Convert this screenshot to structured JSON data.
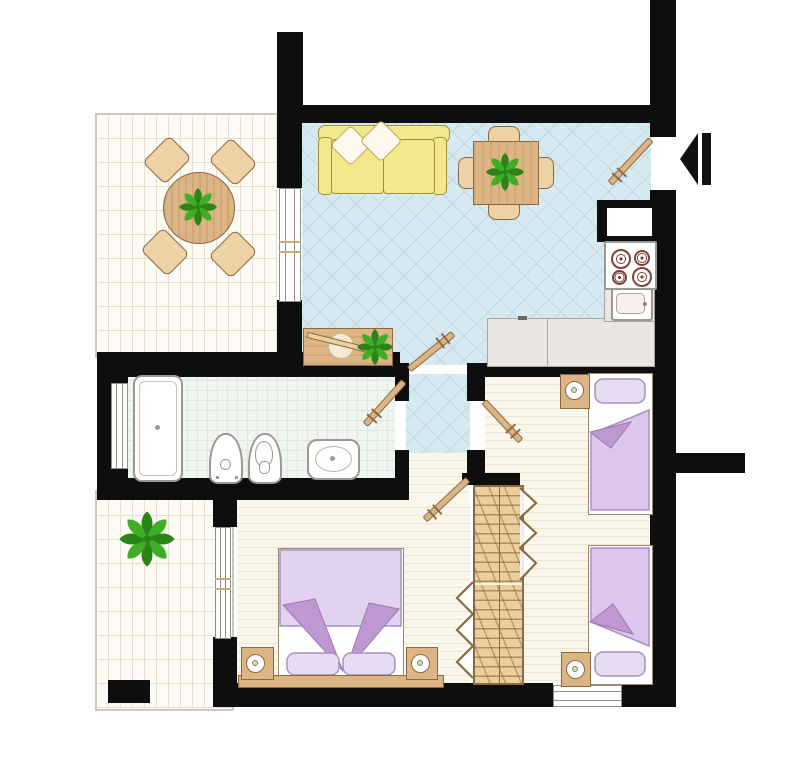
{
  "document": {
    "type": "floor-plan",
    "text_labels": []
  },
  "palette": {
    "wall": "#0e0e0e",
    "floorTerrace": "#fcfbf5",
    "lineTerrace": "#e3e0d3",
    "floorLiving": "#d6e9f0",
    "lineLiving": "#bdd7e1",
    "floorBath": "#eef6ef",
    "lineBath": "#dae9db",
    "floorBedroom": "#f9f6eb",
    "lineBedroom": "#ebe6d4",
    "wood": "#ddb584",
    "woodDark": "#8a6a42",
    "woodLight": "#ecd2a4",
    "sofa": "#f4e88c",
    "sofaLine": "#a39038",
    "purpleLight": "#e3d2ef",
    "purpleMid": "#d9c2ea",
    "purpleDark": "#bf98d2",
    "green": "#3fae27",
    "greenDark": "#2c8417",
    "counter": "#eae7e2",
    "steel": "#9a9a92",
    "burner": "#7c4335",
    "arrow": "#111111"
  },
  "rooms": [
    {
      "id": "terrace",
      "furniture": [
        "round-dining-table",
        "chair",
        "chair",
        "chair",
        "chair",
        "potted-plant"
      ]
    },
    {
      "id": "living-kitchen",
      "furniture": [
        "sofa",
        "pillow",
        "pillow",
        "square-dining-table",
        "chair",
        "chair",
        "chair",
        "chair",
        "potted-plant",
        "console-table",
        "decor-bowl",
        "stove-4-burners",
        "kitchen-sink",
        "l-counter",
        "wall-niche"
      ]
    },
    {
      "id": "hallway",
      "furniture": []
    },
    {
      "id": "bathroom",
      "furniture": [
        "bathtub",
        "bidet",
        "toilet",
        "washbasin"
      ]
    },
    {
      "id": "master-bedroom",
      "furniture": [
        "double-bed",
        "pillow",
        "pillow",
        "nightstand",
        "nightstand",
        "table-lamp",
        "table-lamp",
        "headboard-bench"
      ]
    },
    {
      "id": "second-bedroom",
      "furniture": [
        "single-bed",
        "single-bed",
        "nightstand",
        "nightstand",
        "table-lamp",
        "table-lamp",
        "double-wardrobe"
      ]
    },
    {
      "id": "balcony",
      "furniture": [
        "potted-plant"
      ]
    }
  ],
  "symbols": {
    "entrance_arrow": "left-pointing-triangle",
    "door_count": 5,
    "window_count": 4
  }
}
